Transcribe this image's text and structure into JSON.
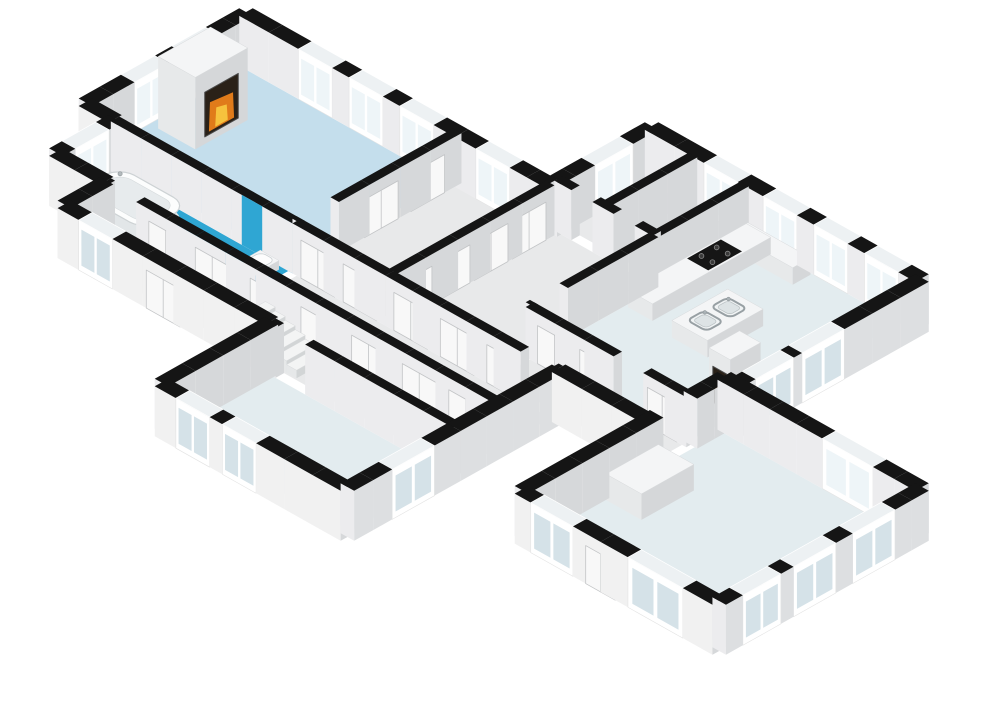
{
  "meta": {
    "description": "isometric 3d floor plan, no visible text"
  },
  "projection": {
    "x0": 246,
    "y0": 62,
    "ux": 8.45,
    "uy": 4.75,
    "wallHeight": 50,
    "doorHeight": 38
  },
  "palette": {
    "background": "#ffffff",
    "wallTop": "#151515",
    "faceInnerLight": "#ececee",
    "faceInnerDark": "#d6d8da",
    "faceOuterLight": "#f1f1f1",
    "faceOuterDark": "#dddfe1",
    "windowFrame": "#ffffff",
    "windowGlassOuter": "#d5e2e8",
    "windowGlassInner": "#eef5f8",
    "windowTop": "#edf1f3",
    "doorFill": "#f8f8f8",
    "doorStroke": "#c2c4c6",
    "floorLiving": "#c4deec",
    "floorBath": "#2fa6d3",
    "floorPale": "#e3ecef",
    "floorHall": "#e8e9ea",
    "showerBlue": "#2fa6d3",
    "fireDark": "#2a2118",
    "fireMid": "#e07b1a",
    "fireCore": "#f6c23d",
    "boxTop": "#f4f5f6",
    "boxFaceV": "#e7e9ea",
    "boxFaceU": "#d5d7d9",
    "stovePlate": "#161616",
    "burner": "#3a3a3a",
    "sinkRim": "#98a0a4",
    "sinkBasin": "#dde3e5",
    "tubFill": "#fcfdfd",
    "tubInner": "#e7ebed",
    "tubStroke": "#cdd2d4",
    "redItem": "#bf3a2b"
  },
  "rooms": [
    {
      "name": "living-room",
      "u0": 0.8,
      "v0": 0.8,
      "u1": 24.5,
      "v1": 18.5,
      "color": "floorLiving"
    },
    {
      "name": "bathroom",
      "u0": 4.0,
      "v0": 19.5,
      "u1": 24.5,
      "v1": 25.5,
      "color": "floorBath"
    },
    {
      "name": "hall-top",
      "u0": 25.5,
      "v0": 0.5,
      "u1": 35.5,
      "v1": 18.5,
      "color": "floorHall"
    },
    {
      "name": "corridor-a",
      "u0": 25.5,
      "v0": 19.5,
      "u1": 55.5,
      "v1": 25.5,
      "color": "floorHall"
    },
    {
      "name": "corridor-b",
      "u0": 10.0,
      "v0": 26.5,
      "u1": 55.5,
      "v1": 30.5,
      "color": "floorHall"
    },
    {
      "name": "storage-1",
      "u0": 36.5,
      "v0": -11.2,
      "u1": 41.0,
      "v1": -1.5,
      "color": "floorHall"
    },
    {
      "name": "storage-2",
      "u0": 42.0,
      "v0": -11.2,
      "u1": 47.1,
      "v1": -1.5,
      "color": "floorHall"
    },
    {
      "name": "closet-hall",
      "u0": 36.5,
      "v0": -0.5,
      "u1": 47.1,
      "v1": 18.5,
      "color": "floorHall"
    },
    {
      "name": "kitchen",
      "u0": 48.1,
      "v0": -11.2,
      "u1": 66.1,
      "v1": 13.5,
      "color": "floorPale"
    },
    {
      "name": "kitchen-hall",
      "u0": 48.1,
      "v0": 14.5,
      "u1": 66.1,
      "v1": 18.5,
      "color": "floorHall"
    },
    {
      "name": "bedroom-1",
      "u0": 34.5,
      "v0": 31.5,
      "u1": 55.5,
      "v1": 43.2,
      "color": "floorPale"
    },
    {
      "name": "bedroom-2",
      "u0": 67.1,
      "v0": 10.8,
      "u1": 89.2,
      "v1": 33.2,
      "color": "floorPale"
    }
  ],
  "walls": [
    {
      "n": "ext-ne-living",
      "ax": "u",
      "c": 0,
      "a": 0,
      "b": 36,
      "t": 1.6,
      "win": [
        [
          7,
          11
        ],
        [
          13,
          17
        ],
        [
          19,
          23
        ],
        [
          28,
          32
        ]
      ]
    },
    {
      "n": "ext-nw-living",
      "ax": "v",
      "c": 0,
      "a": 0,
      "b": 19,
      "t": 1.6,
      "win": [
        [
          4,
          8
        ],
        [
          10,
          14
        ]
      ]
    },
    {
      "n": "ext-w-step",
      "ax": "u",
      "c": 19,
      "a": 0,
      "b": 3.5,
      "t": 1.6,
      "out": 1
    },
    {
      "n": "ext-nw-bath",
      "ax": "v",
      "c": 3.5,
      "a": 19,
      "b": 26,
      "t": 1.6,
      "win": [
        [
          20.5,
          24.5
        ]
      ]
    },
    {
      "n": "ext-sw-bath",
      "ax": "u",
      "c": 26,
      "a": 3.5,
      "b": 9.5,
      "t": 1.6,
      "out": 1
    },
    {
      "n": "ext-w-corridor",
      "ax": "v",
      "c": 9.5,
      "a": 26,
      "b": 31,
      "t": 1.6
    },
    {
      "n": "ext-sw-corridor",
      "ax": "u",
      "c": 31,
      "a": 9.5,
      "b": 34,
      "t": 1.6,
      "out": 1,
      "win": [
        [
          12,
          16
        ]
      ],
      "door": [
        [
          20,
          24
        ]
      ]
    },
    {
      "n": "ext-nw-bed1",
      "ax": "v",
      "c": 34,
      "a": 31,
      "b": 44,
      "t": 1.6
    },
    {
      "n": "ext-sw-bed1",
      "ax": "u",
      "c": 44,
      "a": 34,
      "b": 56,
      "t": 1.6,
      "out": 1,
      "win": [
        [
          36.5,
          40.5
        ],
        [
          42,
          46
        ]
      ]
    },
    {
      "n": "ext-se-bed1",
      "ax": "v",
      "c": 56,
      "a": 19,
      "b": 44,
      "t": 1.6,
      "out": 1,
      "win": [
        [
          34.5,
          39.5
        ]
      ]
    },
    {
      "n": "ext-s-kitchenhall",
      "ax": "u",
      "c": 19,
      "a": 56,
      "b": 66.6,
      "t": 1.6,
      "out": 1
    },
    {
      "n": "int-nw-bed2",
      "ax": "v",
      "c": 66.6,
      "a": 10,
      "b": 34,
      "t": 1.6,
      "gap": [
        [
          14,
          18
        ]
      ]
    },
    {
      "n": "ext-sw-bed2",
      "ax": "u",
      "c": 34,
      "a": 66.6,
      "b": 90,
      "t": 1.6,
      "out": 1,
      "win": [
        [
          68.5,
          73.5
        ],
        [
          80,
          86.5
        ]
      ],
      "door": [
        [
          75,
          78.5
        ]
      ]
    },
    {
      "n": "ext-se-bed2",
      "ax": "v",
      "c": 90,
      "a": 10,
      "b": 34,
      "t": 1.6,
      "out": 1,
      "win": [
        [
          14,
          19
        ],
        [
          21,
          26
        ],
        [
          27.5,
          32
        ]
      ]
    },
    {
      "n": "ext-ne-bed2",
      "ax": "u",
      "c": 10,
      "a": 66.6,
      "b": 90,
      "t": 1.6,
      "win": [
        [
          79,
          85
        ]
      ]
    },
    {
      "n": "ext-se-kitchen",
      "ax": "v",
      "c": 68,
      "a": -12,
      "b": 10,
      "t": 1.6,
      "out": 1,
      "win": [
        [
          -2,
          3
        ],
        [
          4,
          8.5
        ]
      ]
    },
    {
      "n": "ext-ne-kitchen",
      "ax": "u",
      "c": -12,
      "a": 36,
      "b": 68,
      "t": 1.6,
      "win": [
        [
          43,
          47
        ],
        [
          50,
          54
        ],
        [
          56,
          60
        ],
        [
          62,
          66
        ]
      ]
    },
    {
      "n": "ext-nw-storage",
      "ax": "v",
      "c": 36,
      "a": -12,
      "b": 0,
      "t": 1.6,
      "win": [
        [
          -9,
          -4.5
        ]
      ]
    },
    {
      "n": "int-bath-living",
      "ax": "u",
      "c": 19,
      "a": 3.5,
      "b": 25,
      "t": 1,
      "blue": [
        [
          19,
          25
        ]
      ]
    },
    {
      "n": "int-hall-corridor-a",
      "ax": "u",
      "c": 19,
      "a": 25,
      "b": 36,
      "t": 1,
      "door": [
        [
          26,
          30
        ],
        [
          31,
          35
        ]
      ]
    },
    {
      "n": "int-closet-corridor",
      "ax": "u",
      "c": 19,
      "a": 36,
      "b": 56,
      "t": 1,
      "door": [
        [
          37,
          41
        ],
        [
          42.5,
          46.5
        ],
        [
          48,
          51.5
        ]
      ],
      "gap": [
        [
          52,
          55.5
        ]
      ]
    },
    {
      "n": "int-living-hall",
      "ax": "v",
      "c": 25,
      "a": 0,
      "b": 19,
      "t": 1,
      "gap": [
        [
          14.5,
          18.5
        ]
      ],
      "door": [
        [
          2,
          6
        ],
        [
          7.5,
          11.5
        ]
      ]
    },
    {
      "n": "int-corridor-a-b",
      "ax": "u",
      "c": 26,
      "a": 9.5,
      "b": 56,
      "t": 1,
      "gap": [
        [
          10,
          13.5
        ]
      ],
      "door": [
        [
          15,
          19
        ],
        [
          20.5,
          24.5
        ],
        [
          27,
          31
        ],
        [
          33,
          37
        ],
        [
          39,
          43
        ],
        [
          45,
          49
        ],
        [
          50.5,
          54.5
        ]
      ]
    },
    {
      "n": "int-corridor-bed1",
      "ax": "u",
      "c": 31,
      "a": 34,
      "b": 56,
      "t": 1,
      "gap": [
        [
          35,
          38.5
        ]
      ]
    },
    {
      "n": "int-hall-closethall",
      "ax": "v",
      "c": 36,
      "a": 0,
      "b": 19,
      "t": 1,
      "door": [
        [
          1,
          5
        ],
        [
          5.5,
          9.5
        ],
        [
          10,
          14
        ],
        [
          14.5,
          18.5
        ]
      ]
    },
    {
      "n": "int-closethall-kitchen",
      "ax": "v",
      "c": 47.6,
      "a": -11.4,
      "b": 14,
      "t": 1,
      "gap": [
        [
          10,
          13.5
        ]
      ]
    },
    {
      "n": "int-storage-south",
      "ax": "u",
      "c": -1,
      "a": 36,
      "b": 47.6,
      "t": 1,
      "gap": [
        [
          38,
          40.5
        ],
        [
          43,
          45.5
        ]
      ]
    },
    {
      "n": "int-storage-divider",
      "ax": "v",
      "c": 41.5,
      "a": -11.4,
      "b": -1,
      "t": 1
    },
    {
      "n": "int-kitchen-hall",
      "ax": "u",
      "c": 14,
      "a": 47.6,
      "b": 66.6,
      "t": 1,
      "gap": [
        [
          58,
          61.5
        ]
      ],
      "door": [
        [
          49,
          53
        ],
        [
          54,
          57.5
        ],
        [
          62,
          65.5
        ]
      ]
    }
  ],
  "objects": [
    {
      "type": "box",
      "n": "fireplace-living",
      "u0": 1.8,
      "v0": 6,
      "u1": 6.2,
      "v1": 12.2,
      "h": 72,
      "fire": "u"
    },
    {
      "type": "box",
      "n": "kitchen-counter",
      "u0": 48.4,
      "v0": -10.8,
      "u1": 51.3,
      "v1": 3.2,
      "h": 17
    },
    {
      "type": "box",
      "n": "kitchen-counter-2",
      "u0": 48.4,
      "v0": -11,
      "u1": 55.8,
      "v1": -8.9,
      "h": 17
    },
    {
      "type": "stove",
      "n": "stove",
      "u0": 48.6,
      "v0": -7.6,
      "u1": 51.1,
      "v1": -3.6,
      "h": 17
    },
    {
      "type": "box",
      "n": "kitchen-island",
      "u0": 54.2,
      "v0": -2.8,
      "u1": 58.4,
      "v1": 3.8,
      "h": 17
    },
    {
      "type": "sink",
      "n": "sink-1",
      "u0": 55.1,
      "v0": -1.9,
      "u1": 57.4,
      "v1": 0.1,
      "h": 17
    },
    {
      "type": "sink",
      "n": "sink-2",
      "u0": 55.1,
      "v0": 0.9,
      "u1": 57.4,
      "v1": 2.9,
      "h": 17
    },
    {
      "type": "box",
      "n": "fireplace-kitchen",
      "u0": 63.6,
      "v0": 5.2,
      "u1": 66.1,
      "v1": 8.8,
      "h": 58,
      "fire": "v"
    },
    {
      "type": "box",
      "n": "closet-bedroom-2",
      "u0": 67.4,
      "v0": 18.6,
      "u1": 71.6,
      "v1": 24.8,
      "h": 26
    },
    {
      "type": "tub",
      "n": "bathtub",
      "u0": 4.9,
      "v0": 19.9,
      "u1": 13.1,
      "v1": 25.1,
      "h": 13
    },
    {
      "type": "toilet",
      "n": "toilet",
      "u0": 21.6,
      "v0": 19.9,
      "u1": 23.8,
      "v1": 21.9,
      "h": 9
    },
    {
      "type": "stairs",
      "n": "stairs",
      "u0": 29.2,
      "v0": 26.9,
      "v1": 30.3,
      "steps": 6,
      "stepW": 1.18,
      "h0": 27,
      "dh": 3.8
    },
    {
      "type": "box",
      "n": "red-item",
      "u0": 10.6,
      "v0": 29.4,
      "u1": 11.6,
      "v1": 30.3,
      "h": 5,
      "top": "#d3523f",
      "fv": "#bf3a2b",
      "fu": "#a93326"
    }
  ]
}
